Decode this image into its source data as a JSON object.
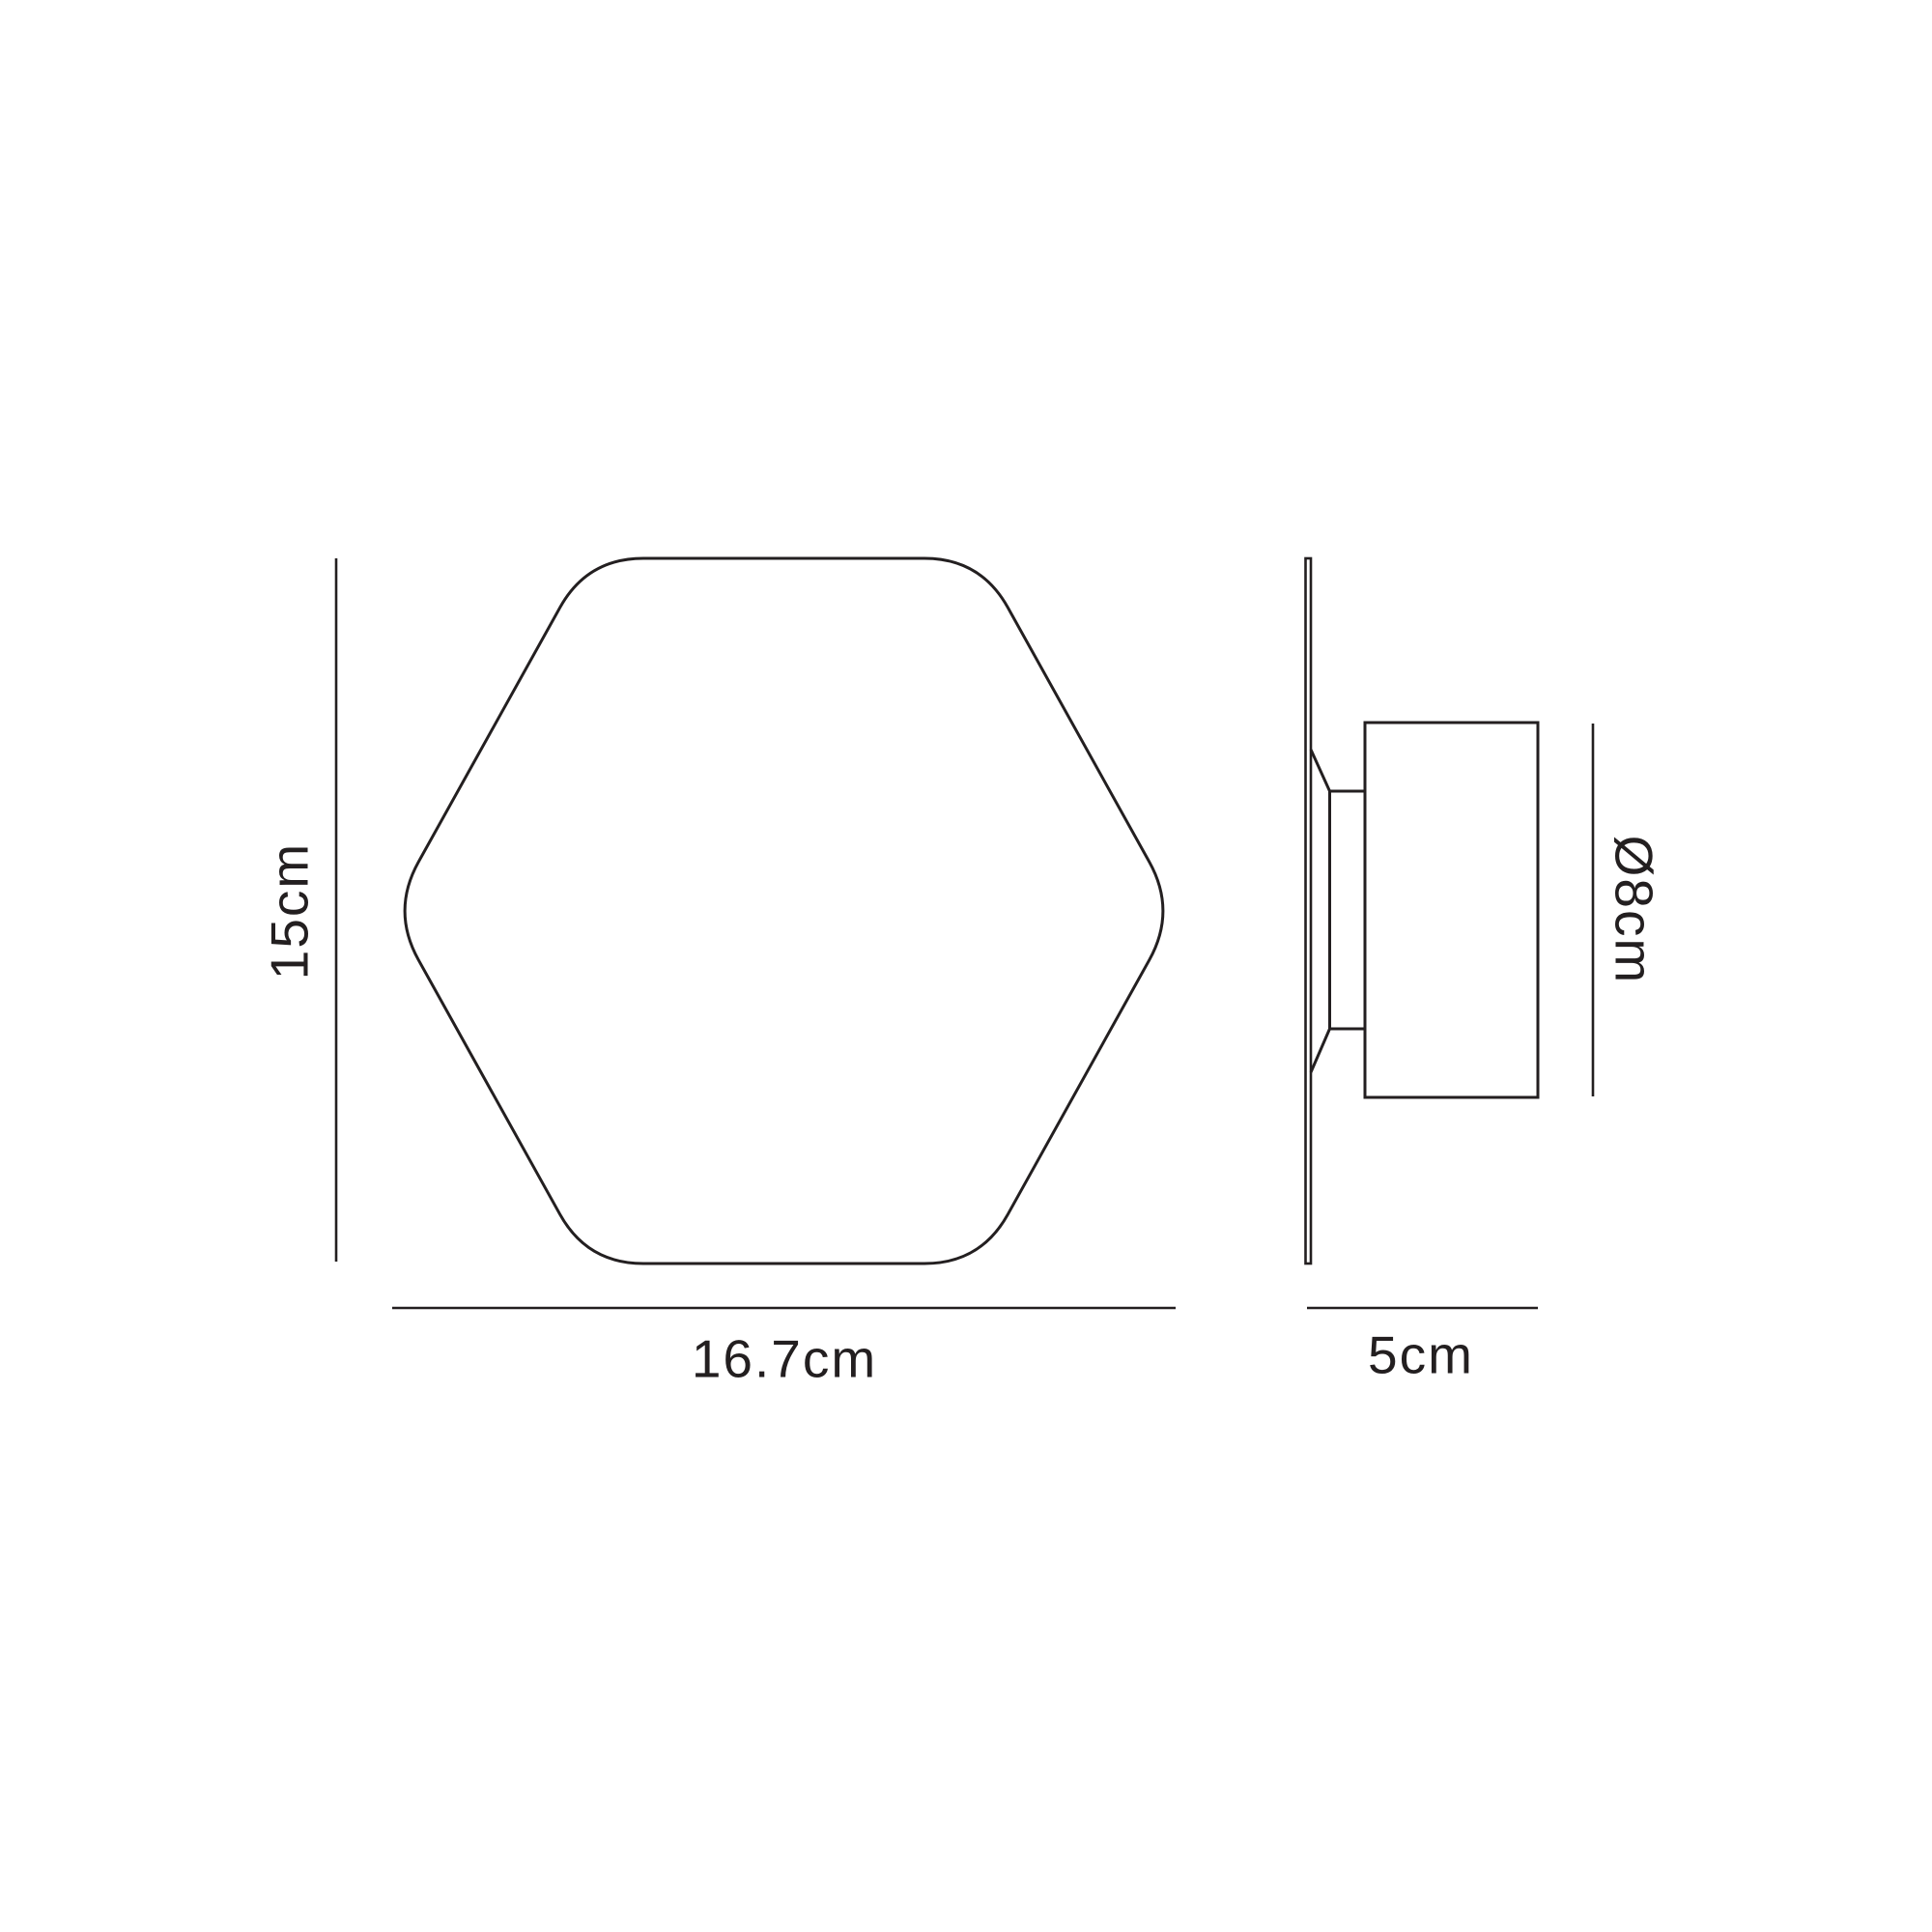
{
  "colors": {
    "line": "#231f20",
    "background": "#ffffff"
  },
  "labels": {
    "front_height": "15cm",
    "front_width": "16.7cm",
    "side_diameter": "Ø8cm",
    "side_depth": "5cm"
  }
}
